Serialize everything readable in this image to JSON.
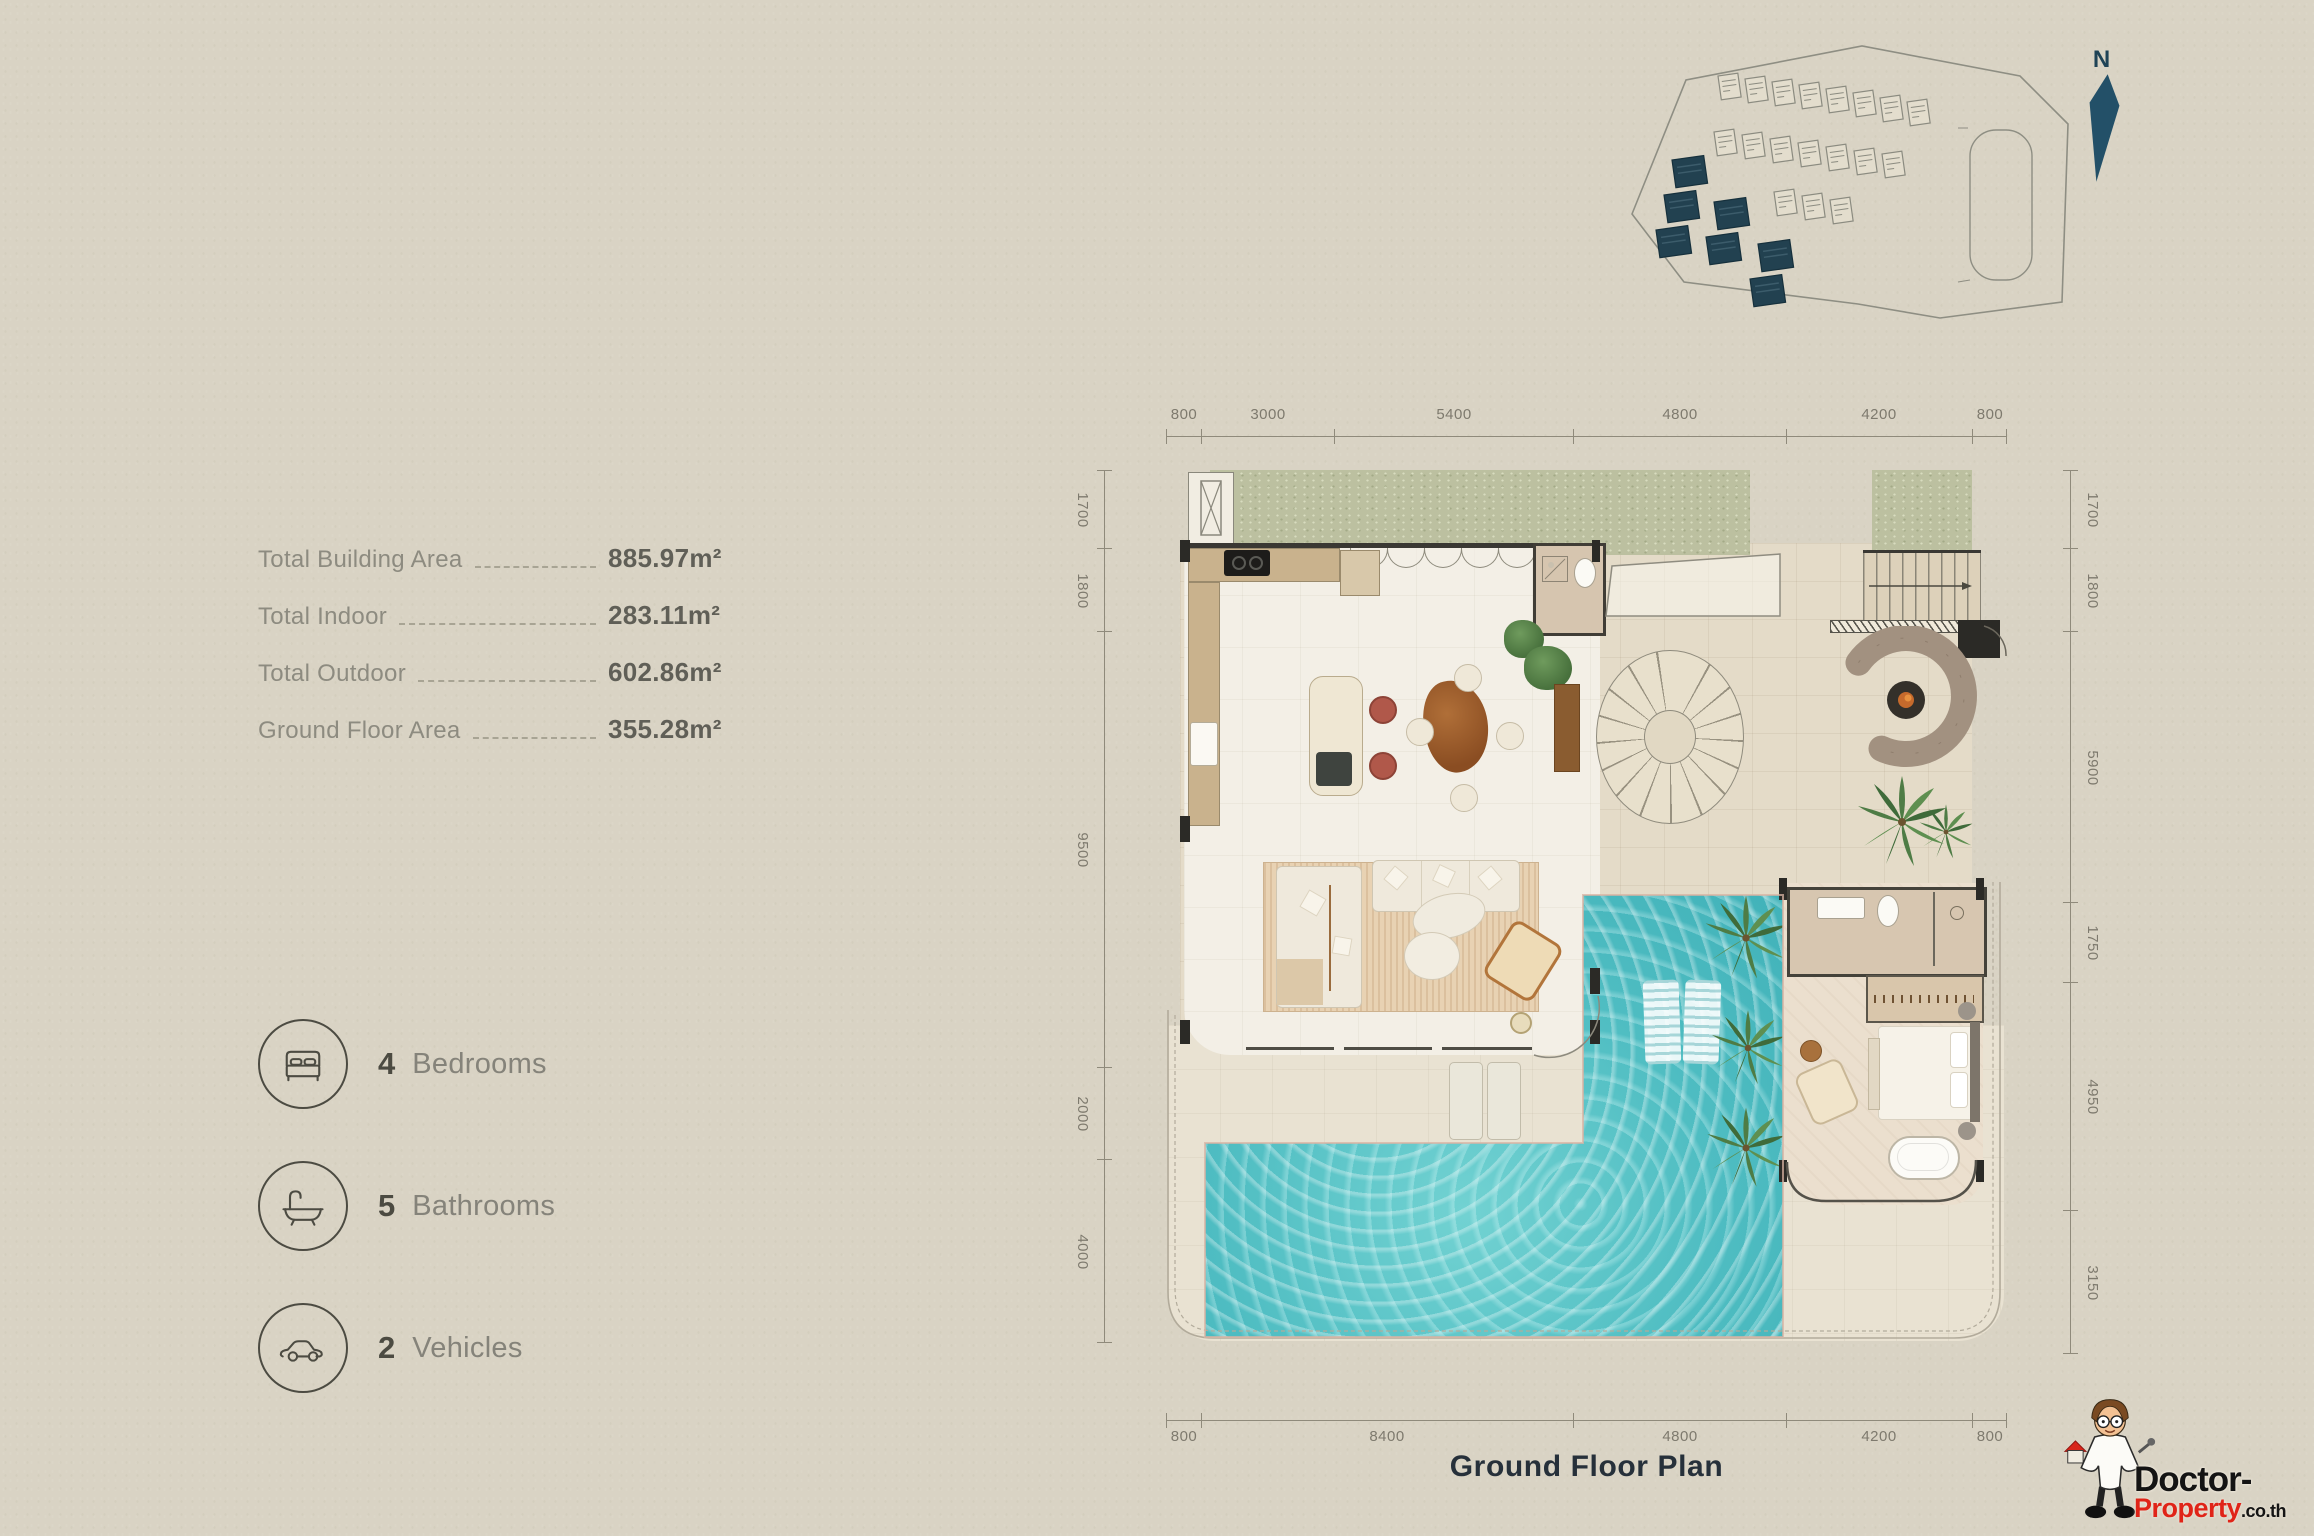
{
  "page": {
    "title": "Ground  Floor Plan"
  },
  "stats": {
    "rows": [
      {
        "label": "Total Building Area",
        "value": "885.97m²"
      },
      {
        "label": "Total Indoor",
        "value": "283.11m²"
      },
      {
        "label": "Total Outdoor",
        "value": "602.86m²"
      },
      {
        "label": "Ground Floor Area",
        "value": "355.28m²"
      }
    ]
  },
  "features": [
    {
      "icon": "bed-icon",
      "count": "4",
      "label": "Bedrooms"
    },
    {
      "icon": "bathtub-icon",
      "count": "5",
      "label": "Bathrooms"
    },
    {
      "icon": "car-icon",
      "count": "2",
      "label": "Vehicles"
    }
  ],
  "dimensions": {
    "top": [
      "800",
      "3000",
      "5400",
      "4800",
      "4200",
      "800"
    ],
    "bottom": [
      "800",
      "8400",
      "4800",
      "4200",
      "800"
    ],
    "left": [
      "1700",
      "1800",
      "9500",
      "2000",
      "4000"
    ],
    "right": [
      "1700",
      "1800",
      "5900",
      "1750",
      "4950",
      "3150"
    ]
  },
  "compass": {
    "label": "N"
  },
  "watermark": {
    "brand_top": "Doctor-",
    "brand_bottom": "Property",
    "brand_suffix": ".co.th"
  },
  "colors": {
    "background": "#d9d3c4",
    "accent_teal": "#224150",
    "pool_water": "#4fbdc2",
    "grass": "#bcc0a0",
    "wall": "#3a3833",
    "brand_red": "#e02418"
  }
}
